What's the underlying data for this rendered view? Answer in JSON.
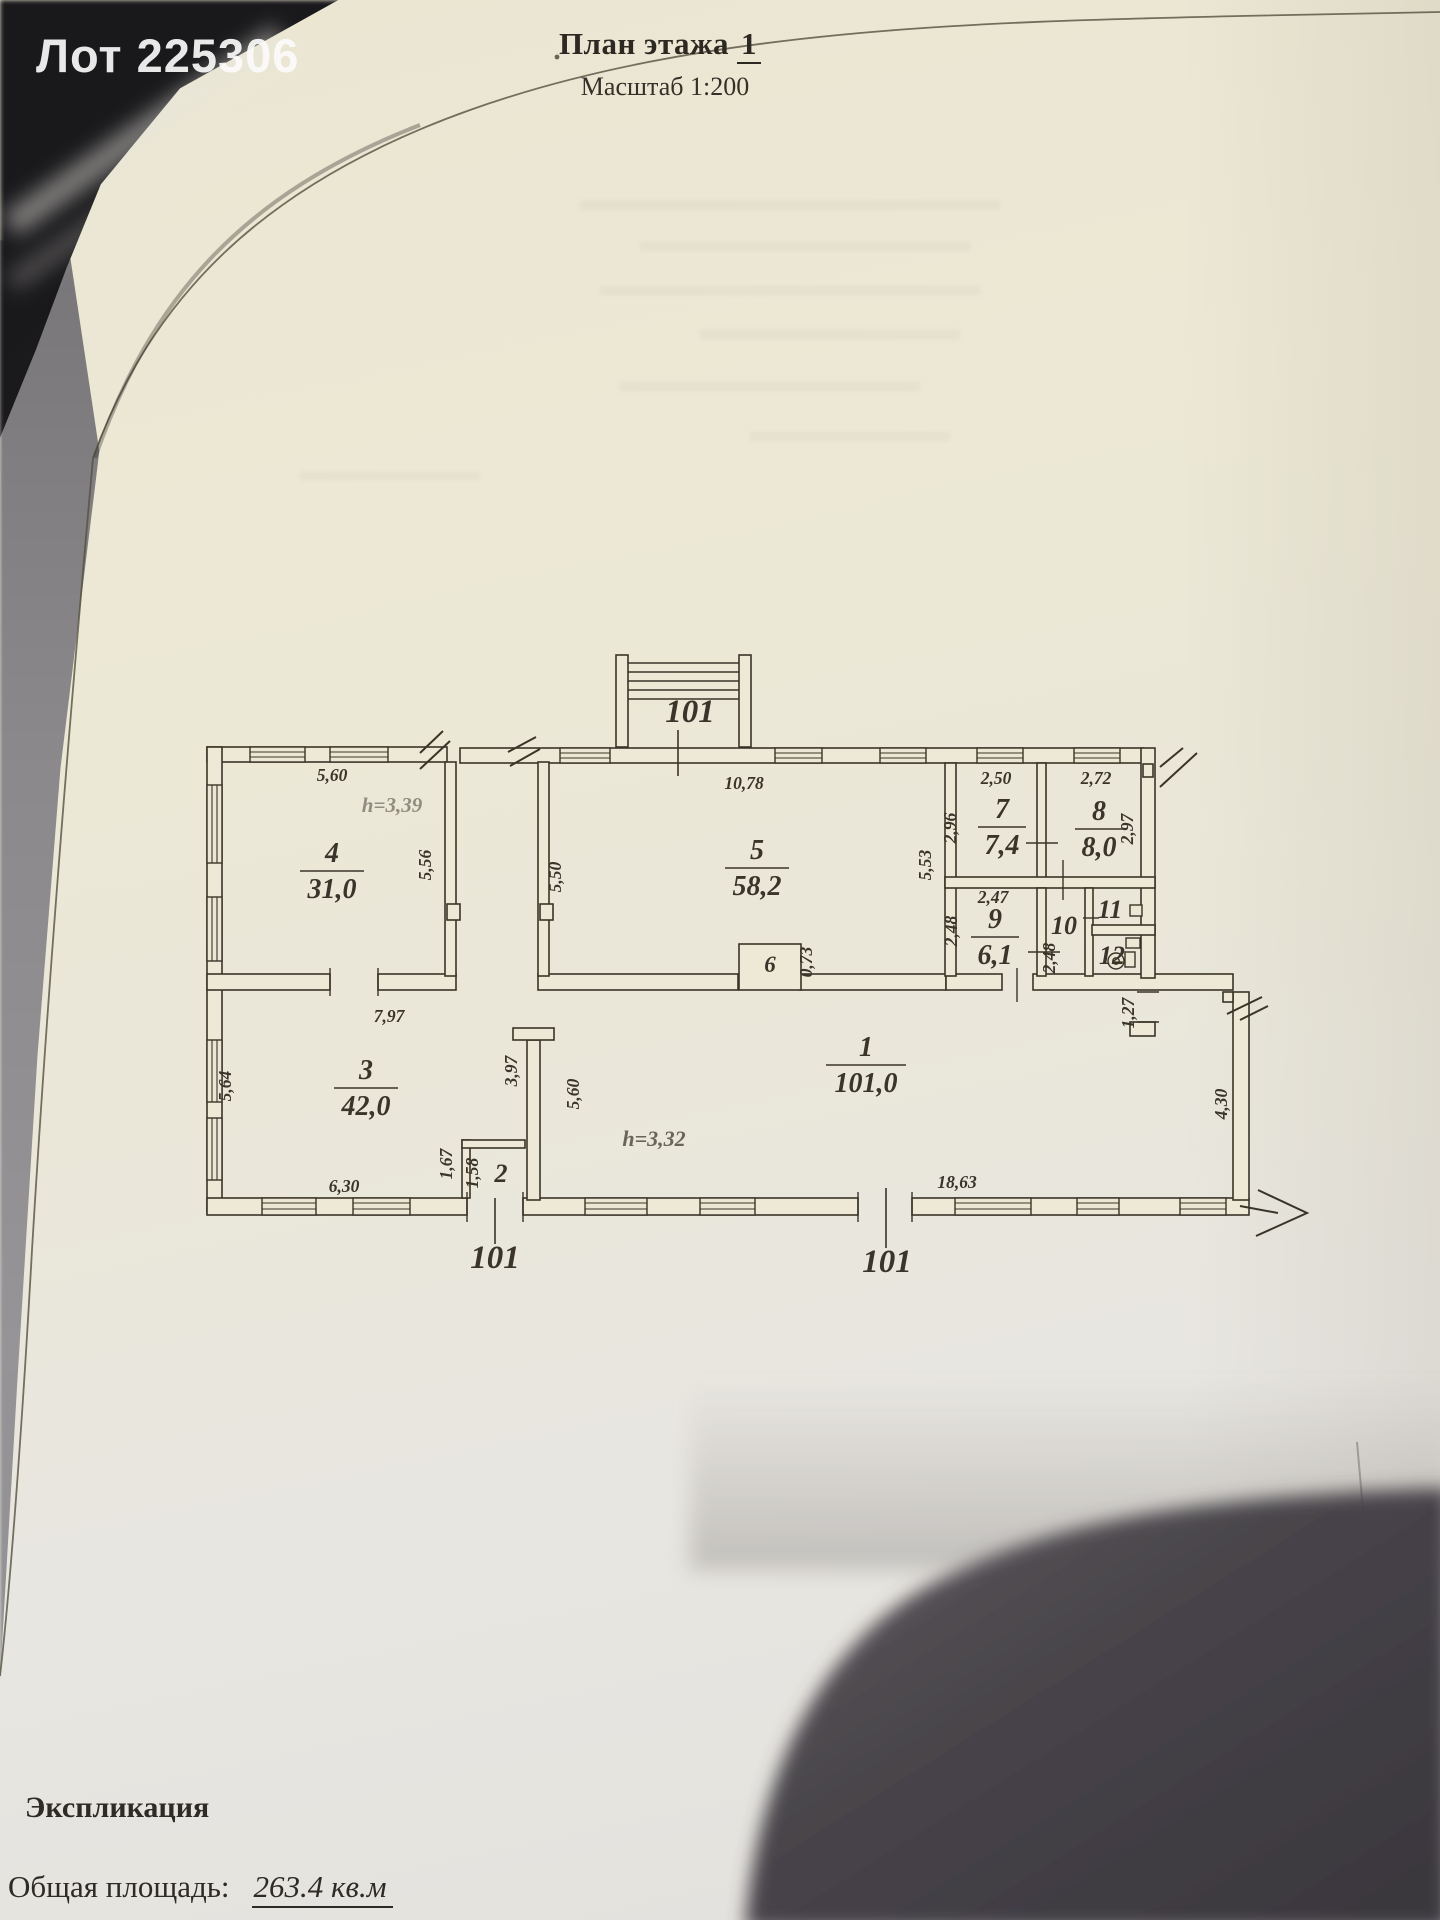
{
  "watermark_text": "Лот 225306",
  "header": {
    "title": "План этажа",
    "floor_number": "1",
    "scale_label": "Масштаб 1:200"
  },
  "footer": {
    "section_title": "Экспликация",
    "total_area_label": "Общая площадь:",
    "total_area_value": "263.4 кв.м"
  },
  "plan": {
    "colors": {
      "ink": "#3a342a",
      "paper": "#ece7d5",
      "height_note": "#8f8a7c"
    },
    "rooms": [
      {
        "number": "1",
        "area": "101,0",
        "x": 866,
        "y": 1062
      },
      {
        "number": "2",
        "area": "",
        "x": 501,
        "y": 1182,
        "size": 26
      },
      {
        "number": "3",
        "area": "42,0",
        "x": 366,
        "y": 1085
      },
      {
        "number": "4",
        "area": "31,0",
        "x": 332,
        "y": 868
      },
      {
        "number": "5",
        "area": "58,2",
        "x": 757,
        "y": 865
      },
      {
        "number": "6",
        "area": "",
        "x": 770,
        "y": 972,
        "size": 23
      },
      {
        "number": "7",
        "area": "7,4",
        "x": 1002,
        "y": 824
      },
      {
        "number": "8",
        "area": "8,0",
        "x": 1099,
        "y": 826
      },
      {
        "number": "9",
        "area": "6,1",
        "x": 995,
        "y": 934
      },
      {
        "number": "10",
        "area": "",
        "x": 1064,
        "y": 934,
        "size": 26
      },
      {
        "number": "11",
        "area": "",
        "x": 1110,
        "y": 918,
        "size": 26
      },
      {
        "number": "12",
        "area": "",
        "x": 1112,
        "y": 964,
        "size": 26
      }
    ],
    "dim_labels": [
      {
        "text": "5,60",
        "x": 332,
        "y": 781
      },
      {
        "text": "h=3,39",
        "x": 392,
        "y": 812,
        "size": 21,
        "color": "#918c80"
      },
      {
        "text": "5,56",
        "x": 431,
        "y": 865,
        "rot": -90
      },
      {
        "text": "10,78",
        "x": 744,
        "y": 789
      },
      {
        "text": "5,50",
        "x": 561,
        "y": 877,
        "rot": -90
      },
      {
        "text": "5,53",
        "x": 931,
        "y": 865,
        "rot": -90
      },
      {
        "text": "2,50",
        "x": 996,
        "y": 784
      },
      {
        "text": "2,72",
        "x": 1096,
        "y": 784
      },
      {
        "text": "2,96",
        "x": 956,
        "y": 828,
        "rot": -90
      },
      {
        "text": "2,97",
        "x": 1133,
        "y": 829,
        "rot": -90
      },
      {
        "text": "2,47",
        "x": 993,
        "y": 903
      },
      {
        "text": "2,48",
        "x": 957,
        "y": 931,
        "rot": -90
      },
      {
        "text": "2,48",
        "x": 1055,
        "y": 958,
        "rot": -90
      },
      {
        "text": "0,73",
        "x": 812,
        "y": 962,
        "rot": -90
      },
      {
        "text": "1,27",
        "x": 1134,
        "y": 1013,
        "rot": -90
      },
      {
        "text": "7,97",
        "x": 389,
        "y": 1022
      },
      {
        "text": "5,64",
        "x": 231,
        "y": 1086,
        "rot": -90
      },
      {
        "text": "3,97",
        "x": 517,
        "y": 1071,
        "rot": -90
      },
      {
        "text": "5,60",
        "x": 579,
        "y": 1094,
        "rot": -90
      },
      {
        "text": "1,67",
        "x": 452,
        "y": 1164,
        "rot": -90
      },
      {
        "text": "1,58",
        "x": 478,
        "y": 1173,
        "rot": -90
      },
      {
        "text": "6,30",
        "x": 344,
        "y": 1192
      },
      {
        "text": "18,63",
        "x": 957,
        "y": 1188
      },
      {
        "text": "4,30",
        "x": 1227,
        "y": 1104,
        "rot": -90
      },
      {
        "text": "h=3,32",
        "x": 654,
        "y": 1146,
        "size": 22,
        "color": "#6b6559"
      }
    ],
    "entry_markers": [
      {
        "text": "101",
        "x": 690,
        "y": 722,
        "lx": 678,
        "ly1": 730,
        "ly2": 776
      },
      {
        "text": "101",
        "x": 495,
        "y": 1268,
        "lx": 495,
        "ly1": 1198,
        "ly2": 1244
      },
      {
        "text": "101",
        "x": 887,
        "y": 1272,
        "lx": 886,
        "ly1": 1188,
        "ly2": 1248
      }
    ]
  }
}
